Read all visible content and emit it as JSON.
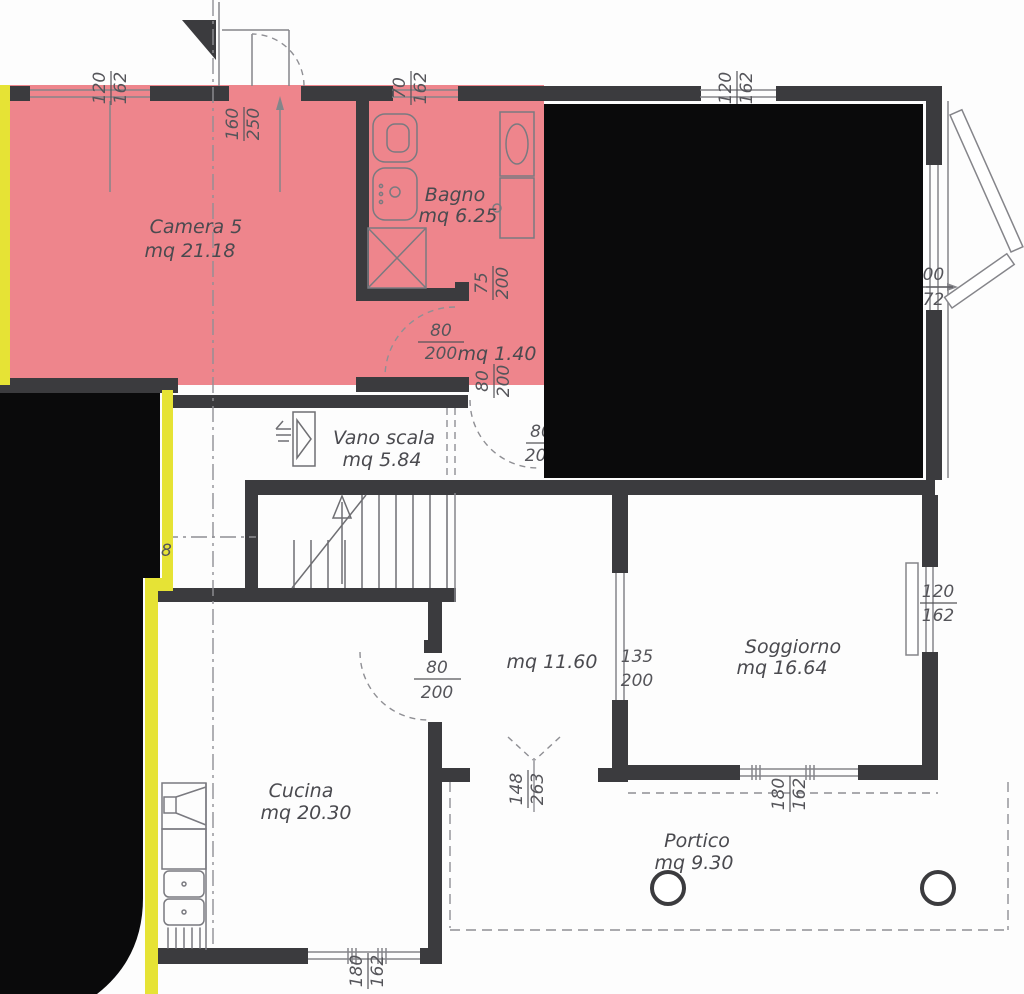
{
  "plan": {
    "rooms": {
      "camera5": {
        "name": "Camera 5",
        "area": "mq 21.18"
      },
      "bagno": {
        "name": "Bagno",
        "area": "mq 6.25"
      },
      "vano_scala": {
        "name": "Vano scala",
        "area": "mq 5.84"
      },
      "disimpegno": {
        "area": "mq 1.40"
      },
      "corridoio": {
        "area": "mq 11.60"
      },
      "cucina": {
        "name": "Cucina",
        "area": "mq 20.30"
      },
      "soggiorno": {
        "name": "Soggiorno",
        "area": "mq 16.64"
      },
      "portico": {
        "name": "Portico",
        "area": "mq 9.30"
      }
    },
    "dims": {
      "win_top_left": {
        "w": "120",
        "h": "162"
      },
      "door_top": {
        "w": "160",
        "h": "250"
      },
      "win_bagno": {
        "w": "70",
        "h": "162"
      },
      "win_top_right": {
        "w": "120",
        "h": "162"
      },
      "door_bagno": {
        "w": "75",
        "h": "200"
      },
      "door_camera": {
        "w": "80",
        "h": "200"
      },
      "door_scala": {
        "w": "80",
        "h": "200"
      },
      "door_hidden": {
        "w": "80",
        "h": "200"
      },
      "win_right": {
        "w": "300",
        "h": "272"
      },
      "opening_soggiorno": {
        "w": "135",
        "h": "200"
      },
      "win_soggiorno_right": {
        "w": "120",
        "h": "162"
      },
      "door_cucina": {
        "w": "80",
        "h": "200"
      },
      "door_portico": {
        "w": "148",
        "h": "263"
      },
      "win_soggiorno_bottom": {
        "w": "180",
        "h": "162"
      },
      "win_cucina": {
        "w": "180",
        "h": "162"
      },
      "fragment_left": "8"
    },
    "colors": {
      "highlight_pink": "#ee858c",
      "highlight_yellow": "#e6e335",
      "redaction": "#0a0a0b",
      "wall": "#3b3b3e"
    }
  }
}
